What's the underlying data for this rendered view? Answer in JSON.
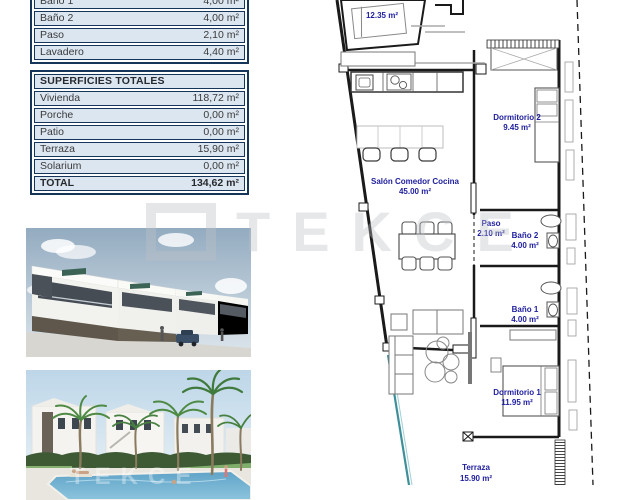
{
  "tables": {
    "rooms": {
      "rows": [
        {
          "label": "Baño 1",
          "value": "4,00 m²"
        },
        {
          "label": "Baño 2",
          "value": "4,00 m²"
        },
        {
          "label": "Paso",
          "value": "2,10 m²"
        },
        {
          "label": "Lavadero",
          "value": "4,40 m²"
        }
      ]
    },
    "totals": {
      "header": "SUPERFICIES TOTALES",
      "rows": [
        {
          "label": "Vivienda",
          "value": "118,72 m²"
        },
        {
          "label": "Porche",
          "value": "0,00 m²"
        },
        {
          "label": "Patio",
          "value": "0,00 m²"
        },
        {
          "label": "Terraza",
          "value": "15,90 m²"
        },
        {
          "label": "Solarium",
          "value": "0,00 m²"
        },
        {
          "label": "TOTAL",
          "value": "134,62 m²"
        }
      ]
    }
  },
  "plan": {
    "rooms": {
      "top_partial": {
        "area": "12.35 m²"
      },
      "salon": {
        "name": "Salón Comedor Cocina",
        "area": "45.00 m²"
      },
      "paso": {
        "name": "Paso",
        "area": "2.10 m²"
      },
      "bano2": {
        "name": "Baño 2",
        "area": "4.00 m²"
      },
      "bano1": {
        "name": "Baño 1",
        "area": "4.00 m²"
      },
      "dorm2": {
        "name": "Dormitorio 2",
        "area": "9.45 m²"
      },
      "dorm1": {
        "name": "Dormitorio 1",
        "area": "11.95 m²"
      },
      "terraza": {
        "name": "Terraza",
        "area": "15.90 m²"
      }
    }
  },
  "watermark": {
    "text": "TEKCE"
  },
  "colors": {
    "table_row_bg": "#dce6f1",
    "table_border": "#15355a",
    "plan_label": "#2020a0",
    "railing_teal": "#3f8f9a"
  }
}
